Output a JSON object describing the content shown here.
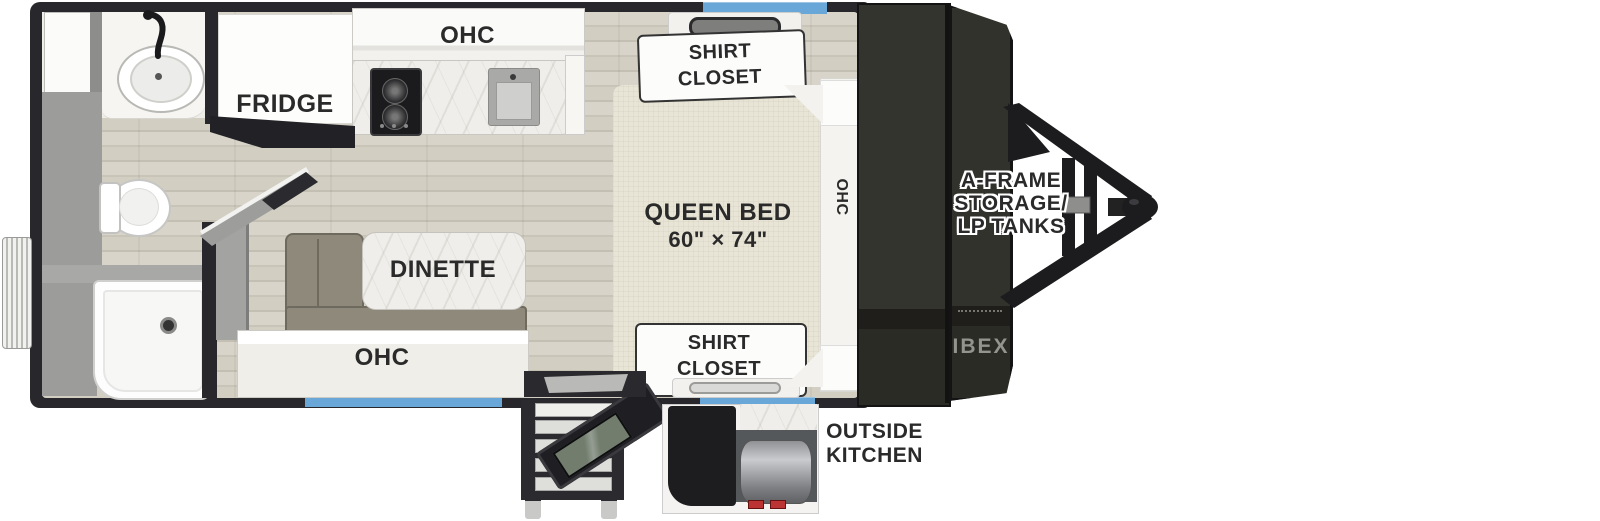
{
  "title": "Travel trailer floorplan",
  "labels": {
    "fridge": "FRIDGE",
    "kitchen_ohc": "OHC",
    "dinette": "DINETTE",
    "bench_ohc": "OHC",
    "queen_bed": "QUEEN BED",
    "bed_size": "60\" × 74\"",
    "bed_ohc": "OHC",
    "closet_top_1": "SHIRT",
    "closet_top_2": "CLOSET",
    "closet_bottom_1": "SHIRT",
    "closet_bottom_2": "CLOSET",
    "aframe_1": "A-FRAME",
    "aframe_2": "STORAGE/",
    "aframe_3": "LP TANKS",
    "outside_1": "OUTSIDE",
    "outside_2": "KITCHEN",
    "brand": "IBEX"
  },
  "colors": {
    "wall": "#27272c",
    "window_blue": "#68a7d8",
    "floor_wood": "#d5d1c6",
    "marble": "#f0eeea",
    "bed_fabric": "#e9e5d6",
    "cushion_olive": "#8e897b",
    "storage_dark": "#32322c",
    "frame_black": "#1c1c1f",
    "knob_red": "#bb3333"
  }
}
